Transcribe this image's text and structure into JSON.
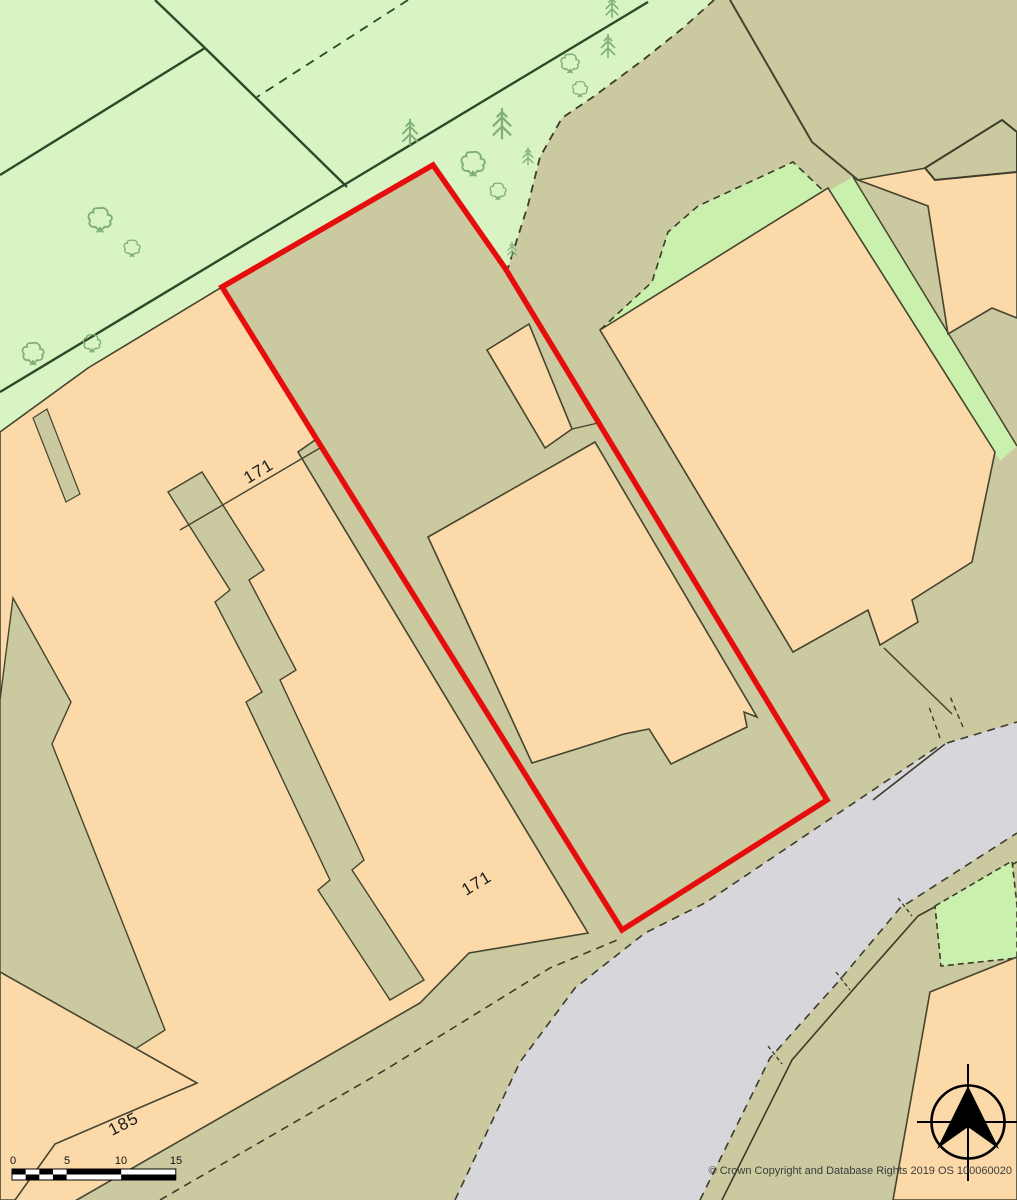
{
  "map": {
    "title": "Site location plan",
    "labels": {
      "plot_171_upper": "171",
      "plot_171_lower": "171",
      "plot_185": "185"
    },
    "scale_bar": {
      "ticks": [
        "0",
        "5",
        "10",
        "15"
      ]
    },
    "copyright": "© Crown Copyright and Database Rights 2019 OS 100060020",
    "compass": "north-arrow",
    "colors": {
      "field_green": "#d8f4c3",
      "pale_green": "#c9f0ad",
      "plot_khaki": "#cac9a0",
      "building_peach": "#fbd9a9",
      "road_grey": "#d7d6da",
      "boundary_red": "#e60d0d",
      "line_dark": "#45442f",
      "field_line": "#2a4a2a",
      "tree_green": "#7fae79"
    }
  }
}
